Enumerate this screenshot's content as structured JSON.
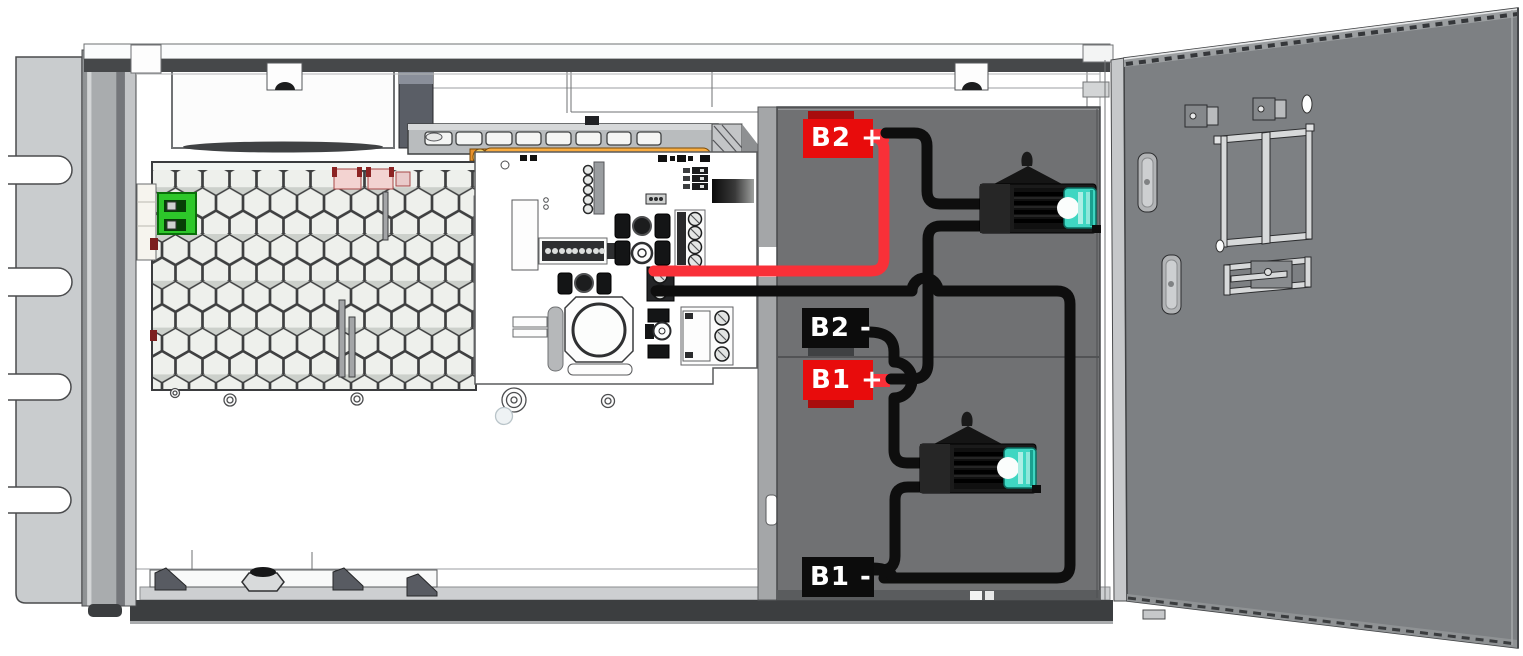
{
  "battery_terminals": [
    {
      "text": "B2 +",
      "polarity": "positive",
      "label_color": "#e80c0c"
    },
    {
      "text": "B2 -",
      "polarity": "negative",
      "label_color": "#0c0c0c"
    },
    {
      "text": "B1 +",
      "polarity": "positive",
      "label_color": "#e80c0c"
    },
    {
      "text": "B1 -",
      "polarity": "negative",
      "label_color": "#0c0c0c"
    }
  ],
  "colors": {
    "wire_red": "#f93038",
    "wire_black": "#0e0e0e",
    "fuse_teal": "#3fd6c2",
    "connector_green": "#2dc72a",
    "compartment_gray": "#707173",
    "door_gray": "#7d8083",
    "copper_orange": "#e8912b"
  }
}
